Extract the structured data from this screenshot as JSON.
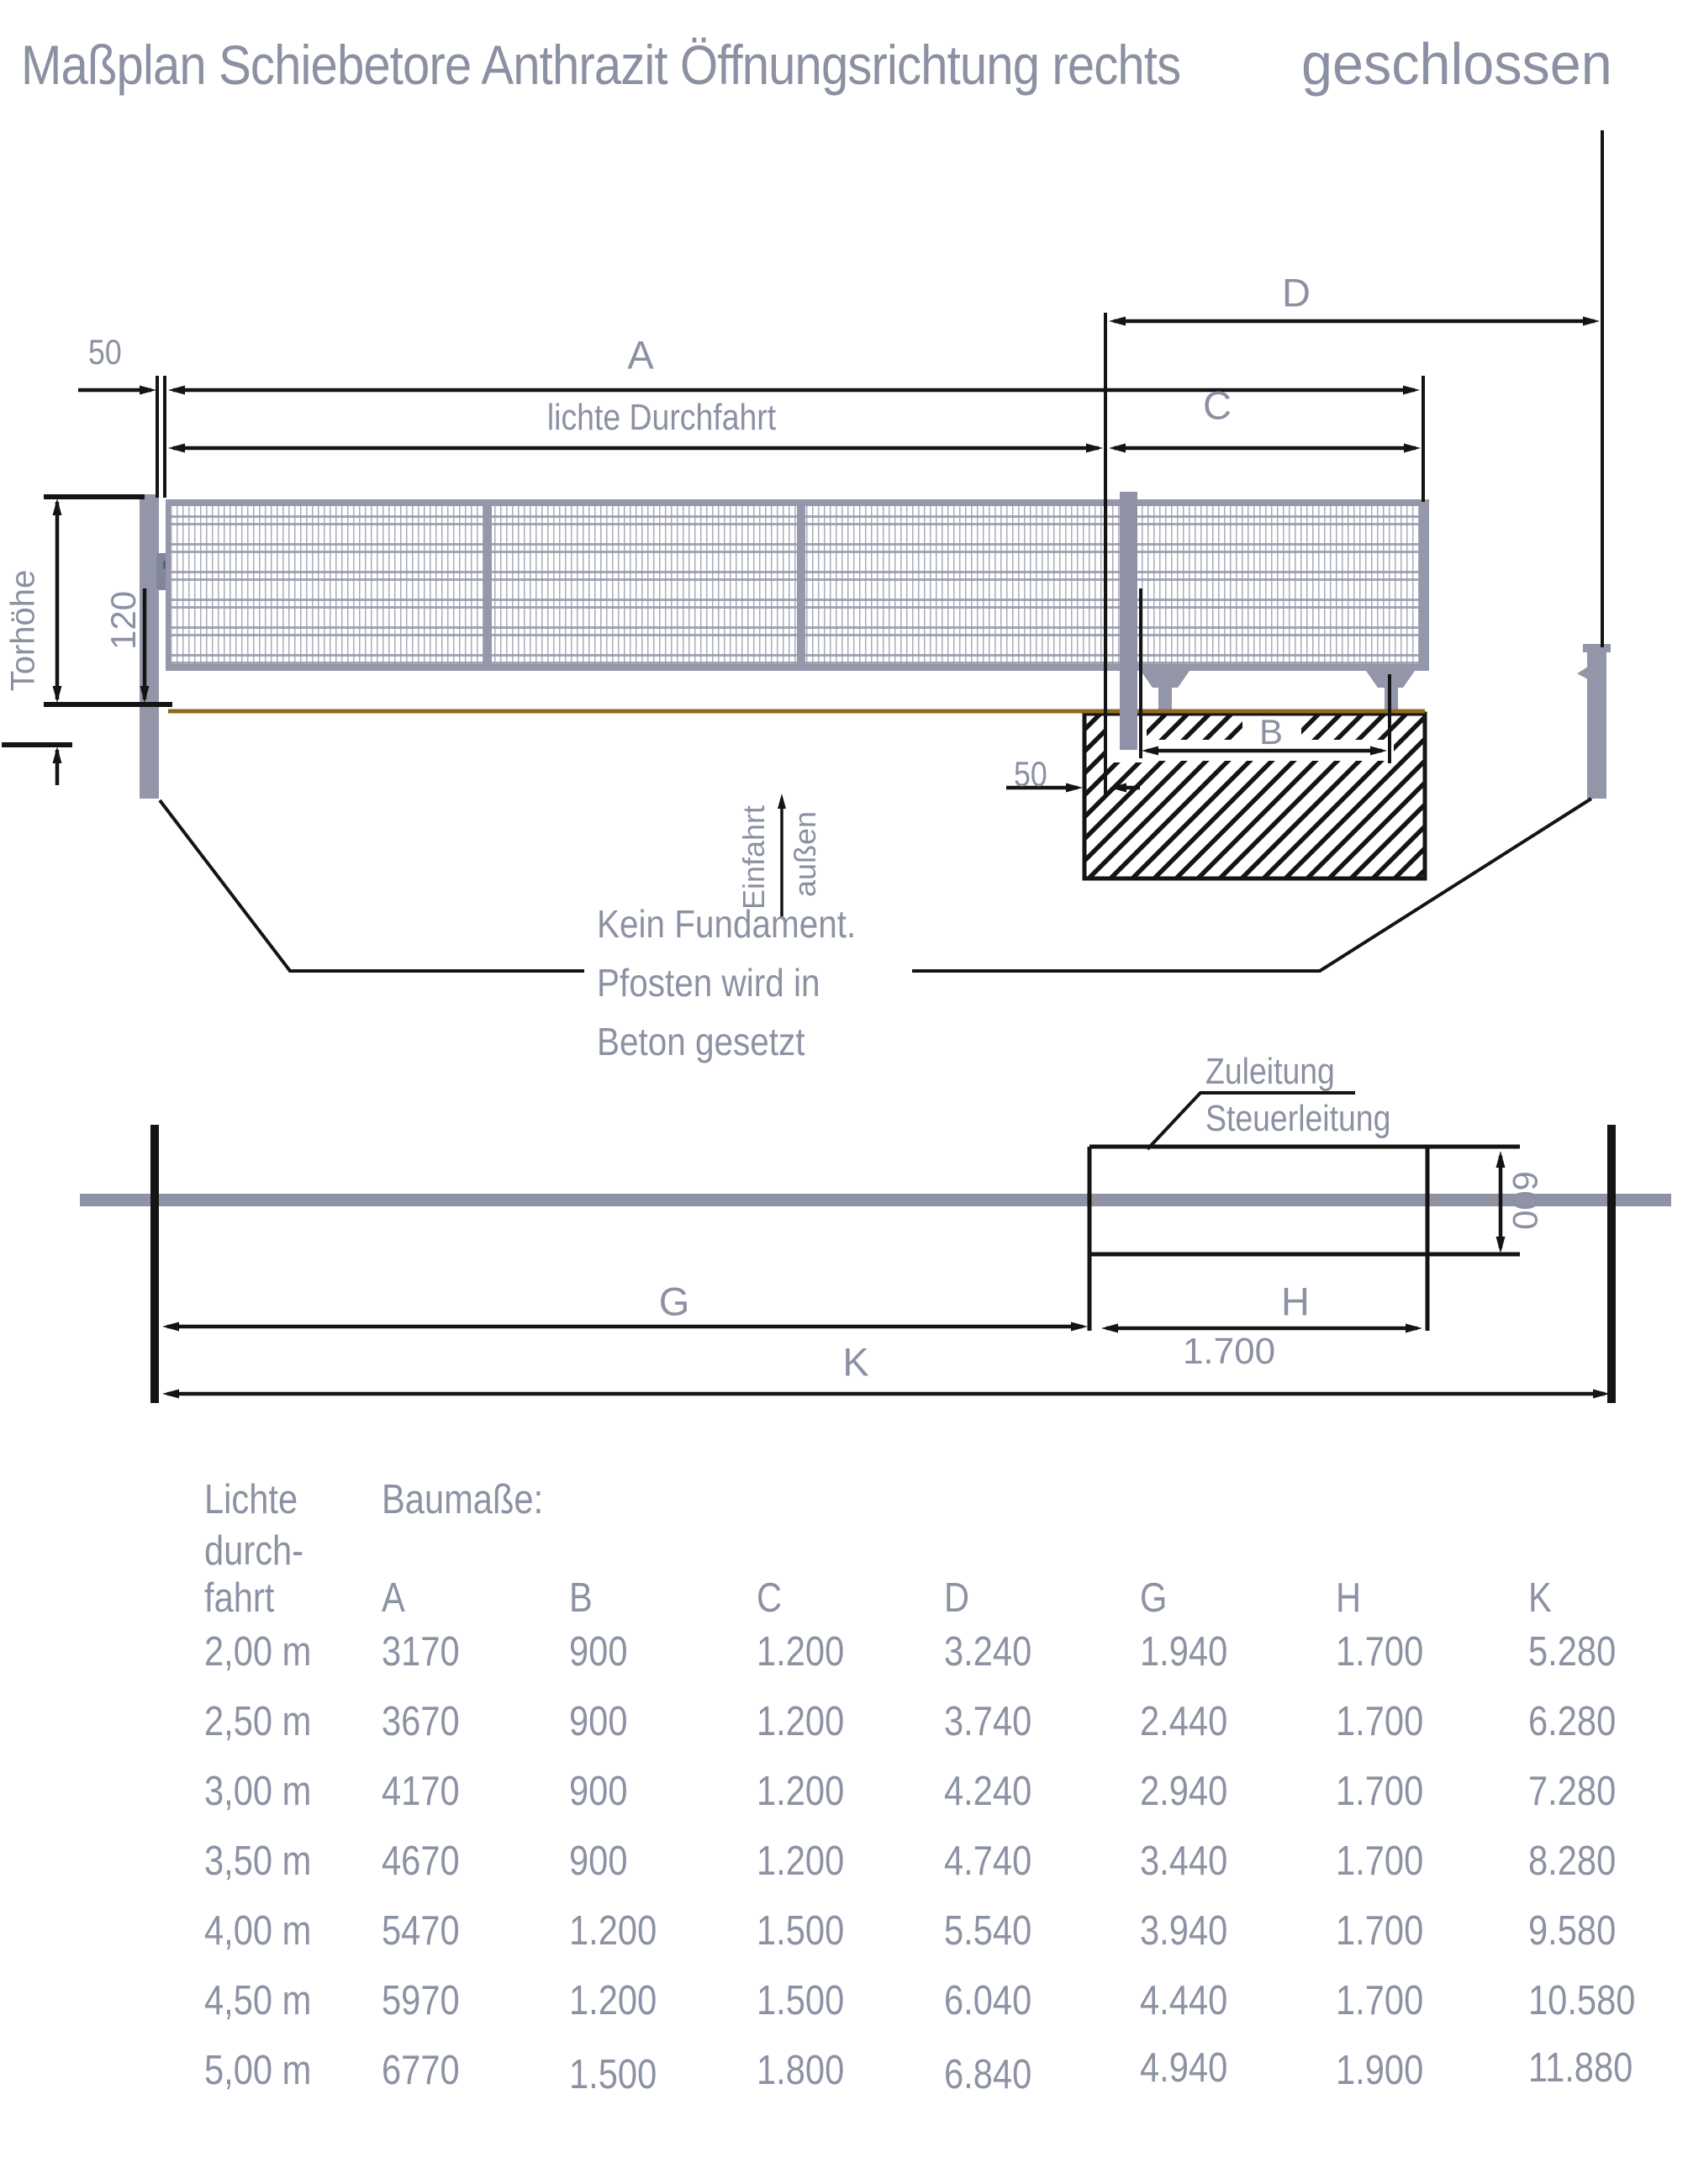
{
  "title": {
    "part1": "Maßplan Schiebetore Anthrazit Öffnungsrichtung rechts ",
    "part2": "geschlossen"
  },
  "colors": {
    "label_gray": "#8b90a3",
    "drawing_gray": "#9497a9",
    "ground_brown": "#8d6a1f",
    "line_black": "#141414"
  },
  "diagram_top": {
    "dim_50_left": "50",
    "dim_A": "A",
    "dim_lichte_durchfahrt": "lichte Durchfahrt",
    "dim_C": "C",
    "dim_D": "D",
    "dim_B": "B",
    "dim_50_foundation": "50",
    "dim_torhoehe": "Torhöhe",
    "dim_120": "120",
    "einfahrt": "Einfahrt",
    "aussen": "außen",
    "note_line1": "Kein Fundament.",
    "note_line2": "Pfosten wird in",
    "note_line3": "Beton gesetzt"
  },
  "diagram_plan": {
    "zuleitung": "Zuleitung",
    "steuerleitung": "Steuerleitung",
    "dim_600": "600",
    "dim_G": "G",
    "dim_H": "H",
    "dim_1700": "1.700",
    "dim_K": "K"
  },
  "table": {
    "row_header_lines": [
      "Lichte",
      "durch-",
      "fahrt"
    ],
    "group_label": "Baumaße:",
    "columns": [
      "A",
      "B",
      "C",
      "D",
      "G",
      "H",
      "K"
    ],
    "rows": [
      [
        "2,00 m",
        "3170",
        "900",
        "1.200",
        "3.240",
        "1.940",
        "1.700",
        "5.280"
      ],
      [
        "2,50 m",
        "3670",
        "900",
        "1.200",
        "3.740",
        "2.440",
        "1.700",
        "6.280"
      ],
      [
        "3,00 m",
        "4170",
        "900",
        "1.200",
        "4.240",
        "2.940",
        "1.700",
        "7.280"
      ],
      [
        "3,50 m",
        "4670",
        "900",
        "1.200",
        "4.740",
        "3.440",
        "1.700",
        "8.280"
      ],
      [
        "4,00 m",
        "5470",
        "1.200",
        "1.500",
        "5.540",
        "3.940",
        "1.700",
        "9.580"
      ],
      [
        "4,50 m",
        "5970",
        "1.200",
        "1.500",
        "6.040",
        "4.440",
        "1.700",
        "10.580"
      ],
      [
        "5,00 m",
        "6770",
        "1.500",
        "1.800",
        "6.840",
        "4.940",
        "1.900",
        "11.880"
      ]
    ]
  }
}
